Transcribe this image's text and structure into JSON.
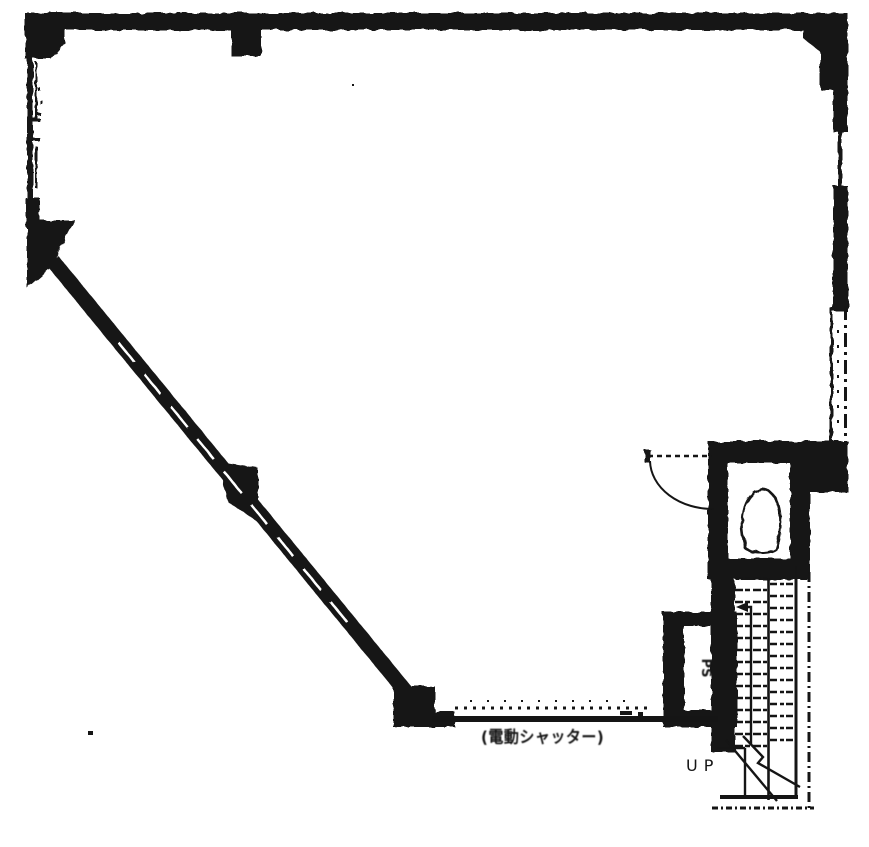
{
  "plan": {
    "title": "scanned-floor-plan",
    "colors": {
      "ink": "#151515",
      "paper": "#ffffff"
    },
    "labels": {
      "up": "UP",
      "shutter": "(電動シャッター)",
      "shaft": "PS"
    }
  }
}
